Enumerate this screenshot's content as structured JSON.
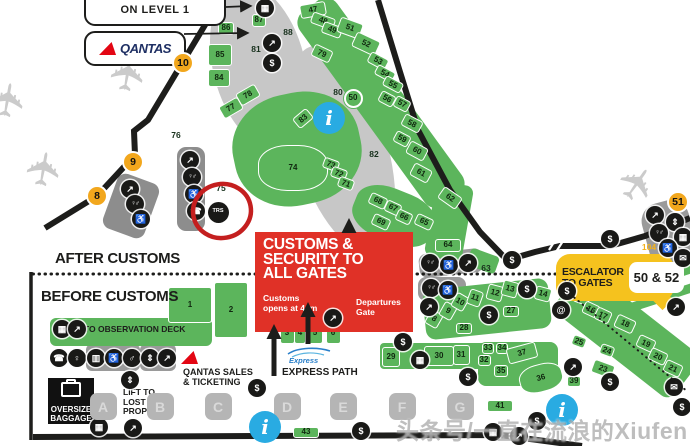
{
  "signs": {
    "level_sign": "ON LEVEL 1",
    "qantas_wordmark": "QANTAS",
    "after_customs": "AFTER CUSTOMS",
    "before_customs": "BEFORE CUSTOMS",
    "customs_box": {
      "title": "CUSTOMS &\nSECURITY TO\nALL GATES",
      "note": "Customs\nopens at 4am",
      "departures": "Departures\nGate"
    },
    "escalator_sign": {
      "label": "ESCALATOR\nTO GATES",
      "gates": "50 & 52"
    },
    "observation_deck": "TO OBSERVATION DECK",
    "qantas_sales": "QANTAS SALES\n& TICKETING",
    "express_logo": "Express",
    "express_path": "EXPRESS PATH",
    "lift_lost_property": "LIFT TO\nLOST\nPROPERTY",
    "oversize_baggage": "OVERSIZE\nBAGGAGE",
    "watermark": "头条号/一直在流浪的Xiufen"
  },
  "colors": {
    "plot_green": "#5cb55c",
    "road_black": "#1d1d1b",
    "gate_yellow": "#f2a71d",
    "sign_yellow": "#f5c21e",
    "customs_red": "#e03127",
    "info_blue": "#29abe2",
    "annotation_red": "#c41f1f"
  },
  "map": {
    "gate_markers": [
      {
        "n": "10",
        "x": 183,
        "y": 63
      },
      {
        "n": "9",
        "x": 133,
        "y": 162
      },
      {
        "n": "8",
        "x": 97,
        "y": 196
      },
      {
        "n": "51",
        "x": 678,
        "y": 202
      }
    ],
    "plots": [
      {
        "n": "87",
        "x": 259,
        "y": 20,
        "w": 14,
        "h": 13
      },
      {
        "n": "86",
        "x": 226,
        "y": 28,
        "w": 16,
        "h": 13
      },
      {
        "n": "85",
        "x": 220,
        "y": 55,
        "w": 24,
        "h": 22
      },
      {
        "n": "84",
        "x": 219,
        "y": 78,
        "w": 22,
        "h": 18
      },
      {
        "n": "47",
        "x": 313,
        "y": 10,
        "w": 26,
        "h": 14,
        "r": -10
      },
      {
        "n": "48",
        "x": 323,
        "y": 21,
        "w": 24,
        "h": 12,
        "r": 20
      },
      {
        "n": "49",
        "x": 332,
        "y": 30,
        "w": 20,
        "h": 12,
        "r": 20
      },
      {
        "n": "51",
        "x": 350,
        "y": 28,
        "w": 24,
        "h": 16,
        "r": 20
      },
      {
        "n": "52",
        "x": 366,
        "y": 44,
        "w": 26,
        "h": 16,
        "r": 25
      },
      {
        "n": "53",
        "x": 378,
        "y": 61,
        "w": 20,
        "h": 12,
        "r": 28
      },
      {
        "n": "54",
        "x": 385,
        "y": 73,
        "w": 20,
        "h": 11,
        "r": 28
      },
      {
        "n": "55",
        "x": 393,
        "y": 84,
        "w": 20,
        "h": 11,
        "r": 28
      },
      {
        "n": "56",
        "x": 387,
        "y": 99,
        "w": 16,
        "h": 12,
        "r": 28
      },
      {
        "n": "57",
        "x": 402,
        "y": 104,
        "w": 16,
        "h": 12,
        "r": 28
      },
      {
        "n": "58",
        "x": 412,
        "y": 123,
        "w": 20,
        "h": 13,
        "r": 28
      },
      {
        "n": "59",
        "x": 402,
        "y": 139,
        "w": 16,
        "h": 12,
        "r": 28
      },
      {
        "n": "60",
        "x": 417,
        "y": 151,
        "w": 20,
        "h": 14,
        "r": 28
      },
      {
        "n": "61",
        "x": 421,
        "y": 173,
        "w": 20,
        "h": 14,
        "r": 28
      },
      {
        "n": "62",
        "x": 450,
        "y": 198,
        "w": 22,
        "h": 14,
        "r": 35
      },
      {
        "n": "79",
        "x": 322,
        "y": 53,
        "w": 20,
        "h": 13,
        "r": 25
      },
      {
        "n": "83",
        "x": 303,
        "y": 118,
        "w": 18,
        "h": 13,
        "r": -40
      },
      {
        "n": "74",
        "x": 293,
        "y": 168,
        "w": 70,
        "h": 46,
        "blob": true
      },
      {
        "n": "73",
        "x": 331,
        "y": 164,
        "w": 16,
        "h": 11,
        "r": 20
      },
      {
        "n": "72",
        "x": 339,
        "y": 173,
        "w": 16,
        "h": 11,
        "r": 20
      },
      {
        "n": "71",
        "x": 346,
        "y": 183,
        "w": 16,
        "h": 11,
        "r": 20
      },
      {
        "n": "77",
        "x": 231,
        "y": 108,
        "w": 22,
        "h": 14,
        "r": -30
      },
      {
        "n": "78",
        "x": 248,
        "y": 95,
        "w": 22,
        "h": 14,
        "r": -30
      },
      {
        "n": "68",
        "x": 378,
        "y": 201,
        "w": 18,
        "h": 12,
        "r": 25
      },
      {
        "n": "67",
        "x": 393,
        "y": 208,
        "w": 16,
        "h": 12,
        "r": 25
      },
      {
        "n": "69",
        "x": 381,
        "y": 222,
        "w": 18,
        "h": 12,
        "r": 25
      },
      {
        "n": "66",
        "x": 404,
        "y": 217,
        "w": 16,
        "h": 12,
        "r": 25
      },
      {
        "n": "65",
        "x": 424,
        "y": 222,
        "w": 18,
        "h": 12,
        "r": 25
      },
      {
        "n": "64",
        "x": 448,
        "y": 245,
        "w": 26,
        "h": 13
      },
      {
        "n": "50",
        "x": 353,
        "y": 98,
        "w": 19,
        "h": 19,
        "circ": true
      },
      {
        "n": "1",
        "x": 190,
        "y": 305,
        "w": 44,
        "h": 36
      },
      {
        "n": "2",
        "x": 231,
        "y": 310,
        "w": 34,
        "h": 56
      },
      {
        "n": "3",
        "x": 287,
        "y": 333,
        "w": 15,
        "h": 22
      },
      {
        "n": "4",
        "x": 300,
        "y": 333,
        "w": 12,
        "h": 22
      },
      {
        "n": "5",
        "x": 315,
        "y": 333,
        "w": 15,
        "h": 22
      },
      {
        "n": "6",
        "x": 333,
        "y": 333,
        "w": 15,
        "h": 22
      },
      {
        "n": "7",
        "x": 403,
        "y": 317,
        "w": 16,
        "h": 30
      },
      {
        "n": "8",
        "x": 434,
        "y": 319,
        "w": 14,
        "h": 16,
        "r": 30
      },
      {
        "n": "9",
        "x": 448,
        "y": 311,
        "w": 14,
        "h": 16,
        "r": 30
      },
      {
        "n": "10",
        "x": 460,
        "y": 302,
        "w": 14,
        "h": 16,
        "r": 30
      },
      {
        "n": "11",
        "x": 475,
        "y": 298,
        "w": 14,
        "h": 16,
        "r": 20
      },
      {
        "n": "12",
        "x": 495,
        "y": 293,
        "w": 16,
        "h": 16,
        "r": 15
      },
      {
        "n": "13",
        "x": 510,
        "y": 289,
        "w": 16,
        "h": 16,
        "r": 15
      },
      {
        "n": "14",
        "x": 543,
        "y": 294,
        "w": 16,
        "h": 14,
        "r": 15
      },
      {
        "n": "15",
        "x": 582,
        "y": 297,
        "w": 16,
        "h": 14,
        "r": 20
      },
      {
        "n": "16",
        "x": 591,
        "y": 309,
        "w": 16,
        "h": 13,
        "r": 25
      },
      {
        "n": "17",
        "x": 603,
        "y": 315,
        "w": 16,
        "h": 13,
        "r": 25
      },
      {
        "n": "18",
        "x": 625,
        "y": 324,
        "w": 20,
        "h": 14,
        "r": 25
      },
      {
        "n": "19",
        "x": 646,
        "y": 343,
        "w": 18,
        "h": 13,
        "r": 25
      },
      {
        "n": "20",
        "x": 658,
        "y": 356,
        "w": 18,
        "h": 13,
        "r": 25
      },
      {
        "n": "21",
        "x": 673,
        "y": 368,
        "w": 18,
        "h": 13,
        "r": 25
      },
      {
        "n": "23",
        "x": 603,
        "y": 369,
        "w": 22,
        "h": 14,
        "r": 20
      },
      {
        "n": "24",
        "x": 607,
        "y": 350,
        "w": 14,
        "h": 11,
        "r": 20
      },
      {
        "n": "25",
        "x": 579,
        "y": 341,
        "w": 14,
        "h": 11,
        "r": 20
      },
      {
        "n": "27",
        "x": 511,
        "y": 311,
        "w": 16,
        "h": 11
      },
      {
        "n": "28",
        "x": 464,
        "y": 328,
        "w": 16,
        "h": 11
      },
      {
        "n": "29",
        "x": 391,
        "y": 357,
        "w": 18,
        "h": 20
      },
      {
        "n": "30",
        "x": 439,
        "y": 356,
        "w": 30,
        "h": 20
      },
      {
        "n": "31",
        "x": 461,
        "y": 355,
        "w": 17,
        "h": 20
      },
      {
        "n": "32",
        "x": 484,
        "y": 360,
        "w": 13,
        "h": 11
      },
      {
        "n": "33",
        "x": 488,
        "y": 348,
        "w": 12,
        "h": 11
      },
      {
        "n": "34",
        "x": 502,
        "y": 348,
        "w": 12,
        "h": 11
      },
      {
        "n": "35",
        "x": 501,
        "y": 371,
        "w": 14,
        "h": 12
      },
      {
        "n": "36",
        "x": 541,
        "y": 378,
        "w": 44,
        "h": 28,
        "r": -15,
        "blob": true
      },
      {
        "n": "37",
        "x": 522,
        "y": 353,
        "w": 30,
        "h": 16,
        "r": -15
      },
      {
        "n": "39",
        "x": 574,
        "y": 381,
        "w": 14,
        "h": 11
      },
      {
        "n": "41",
        "x": 500,
        "y": 406,
        "w": 26,
        "h": 12
      },
      {
        "n": "43",
        "x": 306,
        "y": 432,
        "w": 26,
        "h": 11
      }
    ],
    "area_labels": [
      {
        "t": "88",
        "x": 288,
        "y": 32
      },
      {
        "t": "81",
        "x": 256,
        "y": 49
      },
      {
        "t": "80",
        "x": 338,
        "y": 92
      },
      {
        "t": "82",
        "x": 374,
        "y": 154
      },
      {
        "t": "76",
        "x": 176,
        "y": 135
      },
      {
        "t": "75",
        "x": 221,
        "y": 188
      },
      {
        "t": "63",
        "x": 486,
        "y": 268
      },
      {
        "t": "104",
        "x": 649,
        "y": 247,
        "c": "y"
      }
    ],
    "icons": [
      {
        "t": "atm",
        "x": 265,
        "y": 8
      },
      {
        "t": "escalator",
        "x": 272,
        "y": 43
      },
      {
        "t": "dollar",
        "x": 272,
        "y": 63
      },
      {
        "t": "stairs",
        "x": 130,
        "y": 189
      },
      {
        "t": "toilets",
        "x": 135,
        "y": 204
      },
      {
        "t": "wheelchair",
        "x": 141,
        "y": 219
      },
      {
        "t": "stairs",
        "x": 190,
        "y": 160
      },
      {
        "t": "toilets",
        "x": 192,
        "y": 177
      },
      {
        "t": "wheelchair",
        "x": 194,
        "y": 194
      },
      {
        "t": "phone",
        "x": 196,
        "y": 211
      },
      {
        "t": "trs",
        "x": 218,
        "y": 212
      },
      {
        "t": "dollar",
        "x": 512,
        "y": 260
      },
      {
        "t": "dollar",
        "x": 610,
        "y": 239
      },
      {
        "t": "stairs",
        "x": 655,
        "y": 215
      },
      {
        "t": "lift",
        "x": 675,
        "y": 222
      },
      {
        "t": "toilets",
        "x": 659,
        "y": 233
      },
      {
        "t": "vending",
        "x": 683,
        "y": 237
      },
      {
        "t": "wheelchair",
        "x": 668,
        "y": 248
      },
      {
        "t": "mail",
        "x": 683,
        "y": 258
      },
      {
        "t": "toilets",
        "x": 430,
        "y": 263
      },
      {
        "t": "wheelchair",
        "x": 449,
        "y": 265
      },
      {
        "t": "stairs",
        "x": 468,
        "y": 263
      },
      {
        "t": "toilets",
        "x": 431,
        "y": 288
      },
      {
        "t": "wheelchair",
        "x": 448,
        "y": 290
      },
      {
        "t": "stairs",
        "x": 429,
        "y": 307
      },
      {
        "t": "dollar",
        "x": 489,
        "y": 315
      },
      {
        "t": "dollar",
        "x": 527,
        "y": 289
      },
      {
        "t": "dollar",
        "x": 567,
        "y": 291
      },
      {
        "t": "at",
        "x": 561,
        "y": 310
      },
      {
        "t": "escalator",
        "x": 573,
        "y": 367
      },
      {
        "t": "dollar",
        "x": 610,
        "y": 382
      },
      {
        "t": "mail",
        "x": 674,
        "y": 387
      },
      {
        "t": "dollar",
        "x": 682,
        "y": 407
      },
      {
        "t": "escalator",
        "x": 676,
        "y": 307
      },
      {
        "t": "dollar",
        "x": 403,
        "y": 342
      },
      {
        "t": "atm",
        "x": 420,
        "y": 360
      },
      {
        "t": "vending",
        "x": 62,
        "y": 329
      },
      {
        "t": "stairs",
        "x": 77,
        "y": 329
      },
      {
        "t": "phone",
        "x": 59,
        "y": 358
      },
      {
        "t": "female",
        "x": 77,
        "y": 358
      },
      {
        "t": "shower",
        "x": 96,
        "y": 358
      },
      {
        "t": "wheelchair",
        "x": 114,
        "y": 358
      },
      {
        "t": "male",
        "x": 132,
        "y": 358
      },
      {
        "t": "lift",
        "x": 150,
        "y": 358
      },
      {
        "t": "stairs",
        "x": 167,
        "y": 358
      },
      {
        "t": "lift",
        "x": 130,
        "y": 380
      },
      {
        "t": "atm",
        "x": 99,
        "y": 427
      },
      {
        "t": "escalator",
        "x": 133,
        "y": 428
      },
      {
        "t": "dollar",
        "x": 257,
        "y": 388
      },
      {
        "t": "dollar",
        "x": 361,
        "y": 431
      },
      {
        "t": "dollar",
        "x": 468,
        "y": 377
      },
      {
        "t": "escalator",
        "x": 519,
        "y": 436
      },
      {
        "t": "dollar",
        "x": 537,
        "y": 421
      },
      {
        "t": "atm",
        "x": 493,
        "y": 432
      },
      {
        "t": "escalator",
        "x": 333,
        "y": 318
      }
    ],
    "info_points": [
      {
        "x": 329,
        "y": 118
      },
      {
        "x": 265,
        "y": 427
      },
      {
        "x": 562,
        "y": 410
      }
    ],
    "checkin_rows": [
      {
        "label": "A",
        "x": 103
      },
      {
        "label": "B",
        "x": 160
      },
      {
        "label": "C",
        "x": 218
      },
      {
        "label": "D",
        "x": 287
      },
      {
        "label": "E",
        "x": 343
      },
      {
        "label": "F",
        "x": 402
      },
      {
        "label": "G",
        "x": 460
      }
    ],
    "planes": [
      {
        "x": 132,
        "y": 77,
        "r": -80
      },
      {
        "x": 48,
        "y": 172,
        "r": -80
      },
      {
        "x": 12,
        "y": 103,
        "r": -80
      },
      {
        "x": 641,
        "y": 187,
        "r": -55
      }
    ]
  }
}
